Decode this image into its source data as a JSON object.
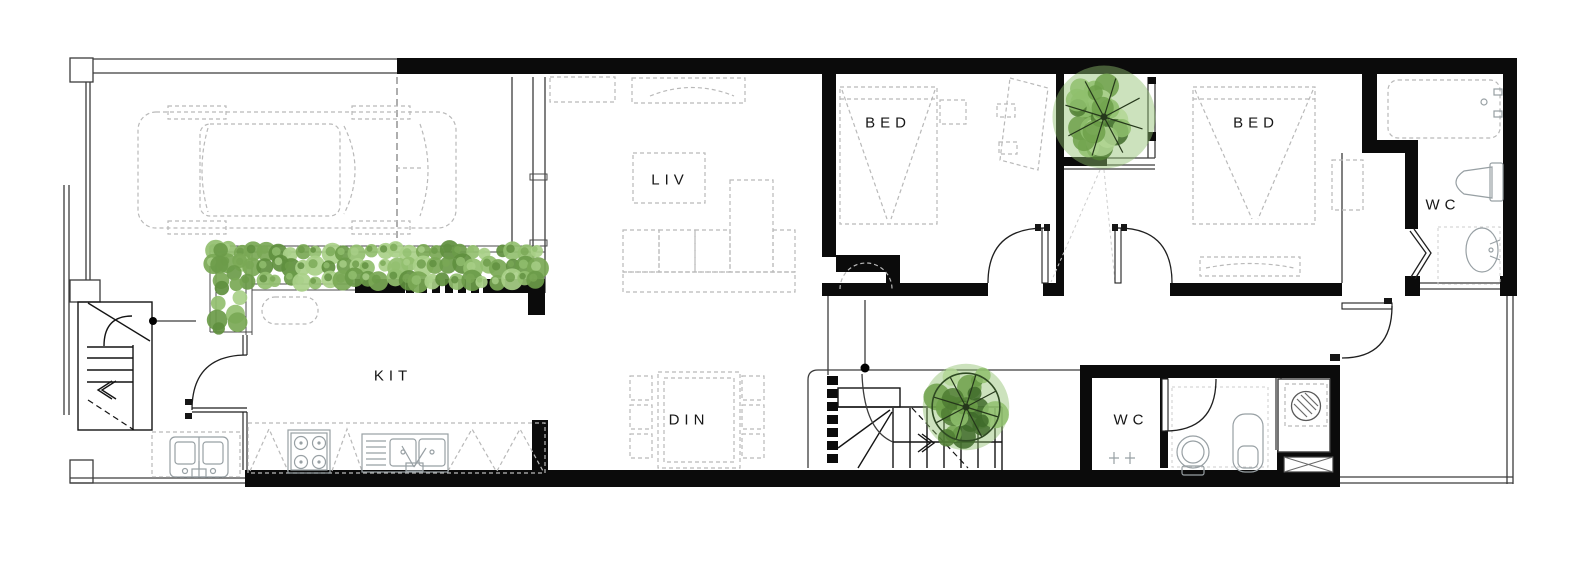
{
  "plan": {
    "title": "house-ground-floor-plan",
    "rooms": {
      "living": {
        "label": "LIV"
      },
      "kitchen": {
        "label": "KIT"
      },
      "dining": {
        "label": "DIN"
      },
      "bedroom_left": {
        "label": "BED"
      },
      "bedroom_right": {
        "label": "BED"
      },
      "bathroom_upper": {
        "label": "WC"
      },
      "bathroom_lower": {
        "label": "WC"
      }
    }
  },
  "landscape": {
    "hedge_colors": [
      "#5f8f3e",
      "#79a855",
      "#92bf6f",
      "#a9d088",
      "#6b9b49"
    ],
    "tree_colors": [
      "#4f7d33",
      "#6da04a",
      "#8fbf6d",
      "#b2d694",
      "#3f6b2a"
    ],
    "ring_color": "#2f4a23",
    "branch_color": "#25371b"
  }
}
